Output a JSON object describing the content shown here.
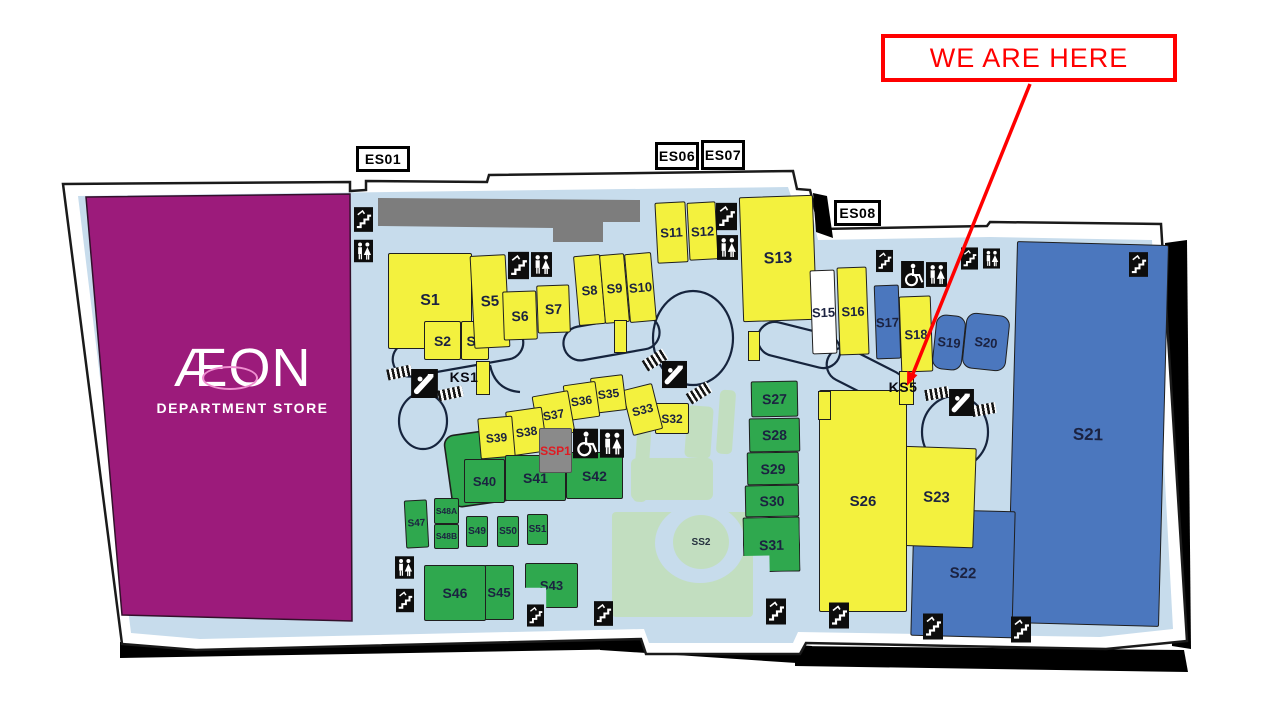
{
  "callout": {
    "label": "WE ARE HERE",
    "color": "#FF0000",
    "points_to": "KS5"
  },
  "anchor_store": {
    "name": "ÆON",
    "subtitle": "DEPARTMENT STORE",
    "color": "#9C1B7B"
  },
  "entrances": [
    {
      "id": "ES01",
      "label": "ES01"
    },
    {
      "id": "ES06",
      "label": "ES06"
    },
    {
      "id": "ES07",
      "label": "ES07"
    },
    {
      "id": "ES08",
      "label": "ES08"
    }
  ],
  "kiosks": [
    {
      "id": "KS1",
      "label": "KS1"
    },
    {
      "id": "KS5",
      "label": "KS5"
    }
  ],
  "landscape": {
    "ss2_label": "SS2"
  },
  "stores": [
    {
      "id": "S1",
      "label": "S1",
      "category": "yellow"
    },
    {
      "id": "S2",
      "label": "S2",
      "category": "yellow"
    },
    {
      "id": "S3",
      "label": "S3",
      "category": "yellow"
    },
    {
      "id": "S5",
      "label": "S5",
      "category": "yellow"
    },
    {
      "id": "S6",
      "label": "S6",
      "category": "yellow"
    },
    {
      "id": "S7",
      "label": "S7",
      "category": "yellow"
    },
    {
      "id": "S8",
      "label": "S8",
      "category": "yellow"
    },
    {
      "id": "S9",
      "label": "S9",
      "category": "yellow"
    },
    {
      "id": "S10",
      "label": "S10",
      "category": "yellow"
    },
    {
      "id": "S11",
      "label": "S11",
      "category": "yellow"
    },
    {
      "id": "S12",
      "label": "S12",
      "category": "yellow"
    },
    {
      "id": "S13",
      "label": "S13",
      "category": "yellow"
    },
    {
      "id": "S15",
      "label": "S15",
      "category": "white"
    },
    {
      "id": "S16",
      "label": "S16",
      "category": "yellow"
    },
    {
      "id": "S17",
      "label": "S17",
      "category": "blue"
    },
    {
      "id": "S18",
      "label": "S18",
      "category": "yellow"
    },
    {
      "id": "S19",
      "label": "S19",
      "category": "blue"
    },
    {
      "id": "S20",
      "label": "S20",
      "category": "blue"
    },
    {
      "id": "S21",
      "label": "S21",
      "category": "blue"
    },
    {
      "id": "S22",
      "label": "S22",
      "category": "blue"
    },
    {
      "id": "S23",
      "label": "S23",
      "category": "yellow"
    },
    {
      "id": "S25",
      "label": "S25",
      "category": "yellow"
    },
    {
      "id": "S26",
      "label": "S26",
      "category": "yellow"
    },
    {
      "id": "S27",
      "label": "S27",
      "category": "green"
    },
    {
      "id": "S28",
      "label": "S28",
      "category": "green"
    },
    {
      "id": "S29",
      "label": "S29",
      "category": "green"
    },
    {
      "id": "S30",
      "label": "S30",
      "category": "green"
    },
    {
      "id": "S31",
      "label": "S31",
      "category": "green"
    },
    {
      "id": "S32",
      "label": "S32",
      "category": "yellow"
    },
    {
      "id": "S33",
      "label": "S33",
      "category": "yellow"
    },
    {
      "id": "S35",
      "label": "S35",
      "category": "yellow"
    },
    {
      "id": "S36",
      "label": "S36",
      "category": "yellow"
    },
    {
      "id": "S37",
      "label": "S37",
      "category": "yellow"
    },
    {
      "id": "S38",
      "label": "S38",
      "category": "yellow"
    },
    {
      "id": "S39",
      "label": "S39",
      "category": "yellow"
    },
    {
      "id": "S40",
      "label": "S40",
      "category": "green"
    },
    {
      "id": "S41",
      "label": "S41",
      "category": "green"
    },
    {
      "id": "S42",
      "label": "S42",
      "category": "green"
    },
    {
      "id": "S43",
      "label": "S43",
      "category": "green"
    },
    {
      "id": "S45",
      "label": "S45",
      "category": "green"
    },
    {
      "id": "S46",
      "label": "S46",
      "category": "green"
    },
    {
      "id": "S47",
      "label": "S47",
      "category": "green"
    },
    {
      "id": "S48A",
      "label": "S48A",
      "category": "green"
    },
    {
      "id": "S48B",
      "label": "S48B",
      "category": "green"
    },
    {
      "id": "S49",
      "label": "S49",
      "category": "green"
    },
    {
      "id": "S50",
      "label": "S50",
      "category": "green"
    },
    {
      "id": "S51",
      "label": "S51",
      "category": "green"
    },
    {
      "id": "SSP1",
      "label": "SSP1",
      "category": "service"
    }
  ],
  "icons": [
    "escalator-icon",
    "stairs-icon",
    "restroom-icon",
    "wheelchair-icon"
  ],
  "legend_colors": {
    "yellow_store": "#F3F13E",
    "green_store": "#2FA84E",
    "blue_store": "#4B77BE",
    "white_store": "#FFFFFF",
    "service_gray": "#8A8A8A",
    "corridor_gray": "#7D7D7D",
    "floor_blue": "#C7DCEC",
    "landscape_green": "#C2DEC0",
    "anchor_magenta": "#9C1B7B",
    "callout_red": "#FF0000"
  }
}
